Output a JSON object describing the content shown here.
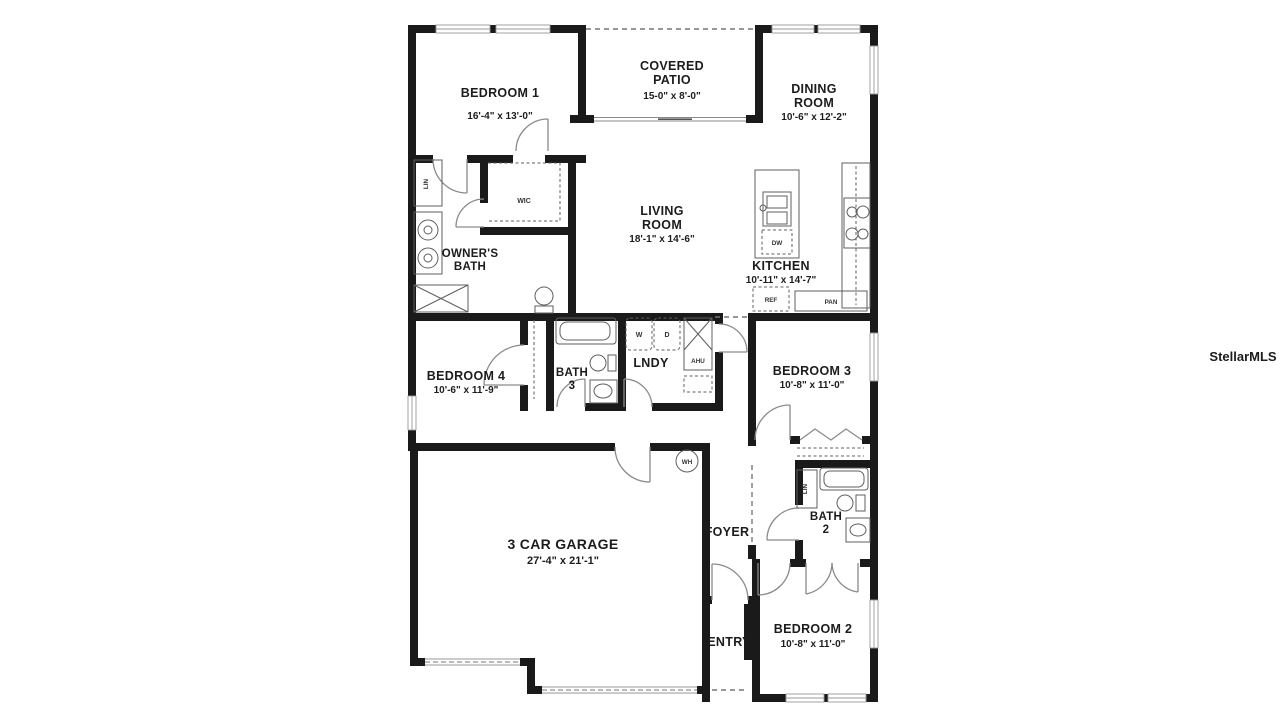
{
  "watermark": "StellarMLS",
  "rooms": {
    "bedroom1": {
      "name": "BEDROOM 1",
      "dims": "16'-4\" x 13'-0\""
    },
    "covered_patio": {
      "name1": "COVERED",
      "name2": "PATIO",
      "dims": "15-0\" x 8'-0\""
    },
    "dining_room": {
      "name1": "DINING",
      "name2": "ROOM",
      "dims": "10'-6\" x 12'-2\""
    },
    "living_room": {
      "name1": "LIVING",
      "name2": "ROOM",
      "dims": "18'-1\" x 14'-6\""
    },
    "owners_bath": {
      "name1": "OWNER'S",
      "name2": "BATH"
    },
    "kitchen": {
      "name": "KITCHEN",
      "dims": "10'-11\" x 14'-7\""
    },
    "bedroom4": {
      "name": "BEDROOM 4",
      "dims": "10'-6\" x 11'-9\""
    },
    "bath3": {
      "name1": "BATH",
      "name2": "3"
    },
    "laundry": {
      "name": "LNDY"
    },
    "bedroom3": {
      "name": "BEDROOM 3",
      "dims": "10'-8\" x 11'-0\""
    },
    "garage": {
      "name": "3 CAR GARAGE",
      "dims": "27'-4\" x 21'-1\""
    },
    "foyer": {
      "name": "FOYER"
    },
    "bath2": {
      "name1": "BATH",
      "name2": "2"
    },
    "entry": {
      "name": "ENTRY"
    },
    "bedroom2": {
      "name": "BEDROOM 2",
      "dims": "10'-8\" x 11'-0\""
    }
  },
  "fixtures": {
    "wic": "WIC",
    "linen_owners": "LIN",
    "linen_bath2": "LIN",
    "washer": "W",
    "dryer": "D",
    "air_handler": "AHU",
    "dishwasher": "DW",
    "refrigerator": "REF",
    "pantry": "PAN",
    "water_heater": "WH"
  },
  "colors": {
    "wall": "#1a1a1a",
    "background": "#ffffff",
    "fixture_line": "#5f5f5f",
    "door_line": "#8a8a8a",
    "watermark": "#e2e2e2"
  }
}
